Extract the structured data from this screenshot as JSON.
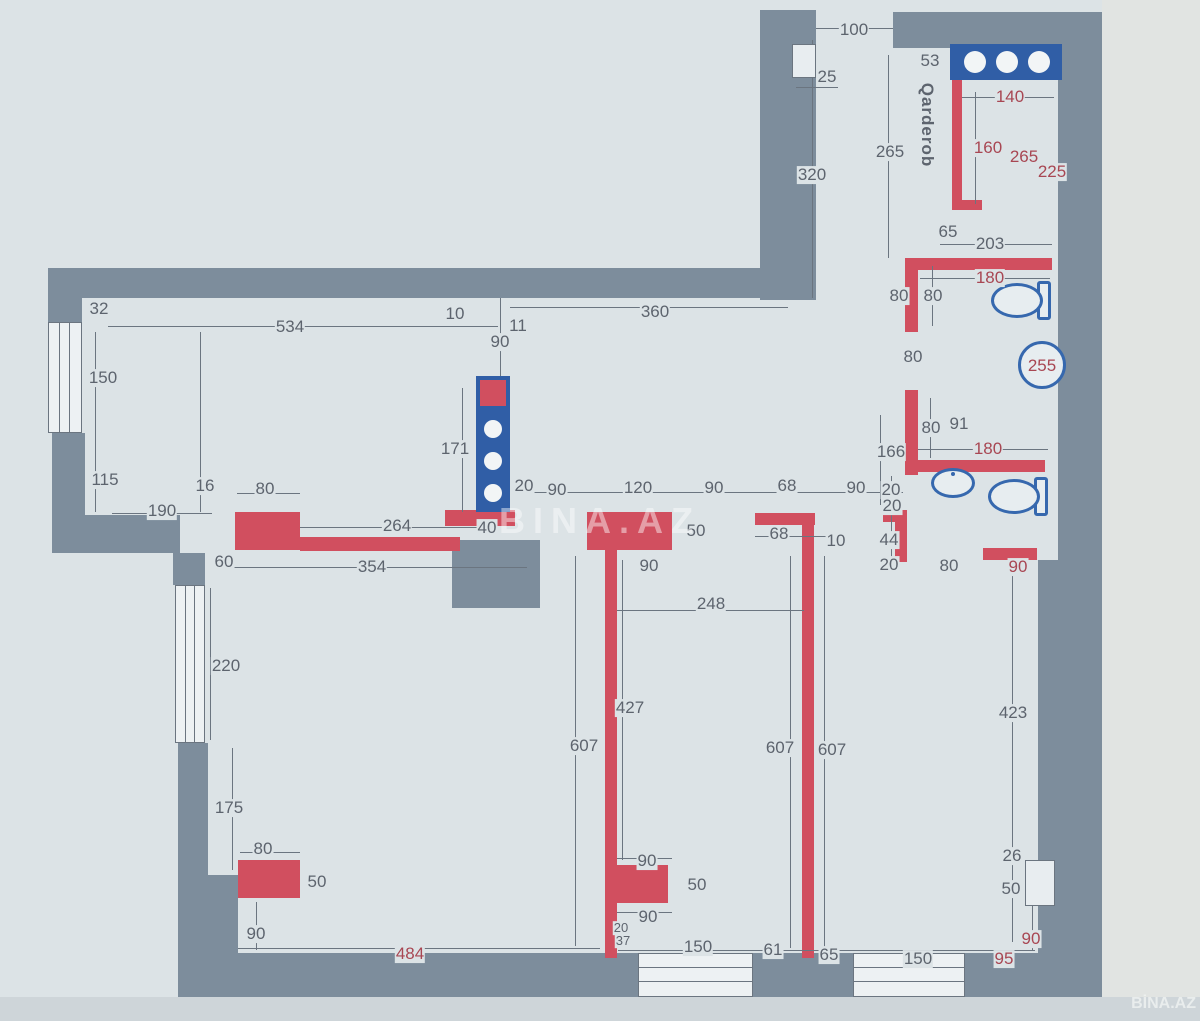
{
  "plan": {
    "colors": {
      "paper": "#dce3e6",
      "wall_gray": "#7d8d9c",
      "wall_red": "#d14f5f",
      "fixture_blue": "#3668ae",
      "shelf_blue": "#305ea6",
      "label_dark": "#5d646e",
      "label_red": "#a84753"
    },
    "room_label": {
      "text": "Qarderob"
    },
    "labels": [
      {
        "t": "100",
        "x": 854,
        "y": 30
      },
      {
        "t": "25",
        "x": 827,
        "y": 77
      },
      {
        "t": "320",
        "x": 812,
        "y": 175
      },
      {
        "t": "53",
        "x": 930,
        "y": 61
      },
      {
        "t": "Qarderob",
        "x": 927,
        "y": 125,
        "v": 1,
        "n": "room-label-qarderob"
      },
      {
        "t": "265",
        "x": 890,
        "y": 152
      },
      {
        "t": "140",
        "x": 1010,
        "y": 97,
        "c": "r"
      },
      {
        "t": "160",
        "x": 988,
        "y": 148,
        "c": "r"
      },
      {
        "t": "265",
        "x": 1024,
        "y": 157,
        "c": "r"
      },
      {
        "t": "225",
        "x": 1052,
        "y": 172,
        "c": "r"
      },
      {
        "t": "65",
        "x": 948,
        "y": 232
      },
      {
        "t": "203",
        "x": 990,
        "y": 244
      },
      {
        "t": "180",
        "x": 990,
        "y": 278,
        "c": "r"
      },
      {
        "t": "80",
        "x": 899,
        "y": 296
      },
      {
        "t": "80",
        "x": 933,
        "y": 296
      },
      {
        "t": "80",
        "x": 913,
        "y": 357
      },
      {
        "t": "255",
        "x": 1042,
        "y": 366,
        "c": "r",
        "nb": 1
      },
      {
        "t": "80",
        "x": 931,
        "y": 428
      },
      {
        "t": "91",
        "x": 959,
        "y": 424
      },
      {
        "t": "166",
        "x": 891,
        "y": 452
      },
      {
        "t": "180",
        "x": 988,
        "y": 449,
        "c": "r"
      },
      {
        "t": "20",
        "x": 892,
        "y": 506
      },
      {
        "t": "44",
        "x": 889,
        "y": 540
      },
      {
        "t": "20",
        "x": 889,
        "y": 565
      },
      {
        "t": "80",
        "x": 949,
        "y": 566
      },
      {
        "t": "90",
        "x": 1018,
        "y": 567,
        "c": "r"
      },
      {
        "t": "32",
        "x": 99,
        "y": 309
      },
      {
        "t": "534",
        "x": 290,
        "y": 327
      },
      {
        "t": "10",
        "x": 455,
        "y": 314
      },
      {
        "t": "11",
        "x": 518,
        "y": 326
      },
      {
        "t": "90",
        "x": 500,
        "y": 342
      },
      {
        "t": "360",
        "x": 655,
        "y": 312
      },
      {
        "t": "150",
        "x": 103,
        "y": 378
      },
      {
        "t": "115",
        "x": 105,
        "y": 480
      },
      {
        "t": "190",
        "x": 162,
        "y": 511
      },
      {
        "t": "16",
        "x": 205,
        "y": 486
      },
      {
        "t": "80",
        "x": 265,
        "y": 489
      },
      {
        "t": "171",
        "x": 455,
        "y": 449
      },
      {
        "t": "20",
        "x": 524,
        "y": 486
      },
      {
        "t": "264",
        "x": 397,
        "y": 526
      },
      {
        "t": "40",
        "x": 487,
        "y": 528
      },
      {
        "t": "354",
        "x": 372,
        "y": 567
      },
      {
        "t": "60",
        "x": 224,
        "y": 562
      },
      {
        "t": "90",
        "x": 557,
        "y": 490
      },
      {
        "t": "120",
        "x": 638,
        "y": 488
      },
      {
        "t": "90",
        "x": 714,
        "y": 488
      },
      {
        "t": "68",
        "x": 787,
        "y": 486
      },
      {
        "t": "90",
        "x": 856,
        "y": 488
      },
      {
        "t": "20",
        "x": 891,
        "y": 490
      },
      {
        "t": "50",
        "x": 696,
        "y": 531
      },
      {
        "t": "68",
        "x": 779,
        "y": 534
      },
      {
        "t": "10",
        "x": 836,
        "y": 541
      },
      {
        "t": "90",
        "x": 649,
        "y": 566
      },
      {
        "t": "248",
        "x": 711,
        "y": 604
      },
      {
        "t": "220",
        "x": 226,
        "y": 666
      },
      {
        "t": "175",
        "x": 229,
        "y": 808
      },
      {
        "t": "80",
        "x": 263,
        "y": 849
      },
      {
        "t": "50",
        "x": 317,
        "y": 882
      },
      {
        "t": "90",
        "x": 256,
        "y": 934
      },
      {
        "t": "484",
        "x": 410,
        "y": 954,
        "c": "r"
      },
      {
        "t": "427",
        "x": 630,
        "y": 708
      },
      {
        "t": "607",
        "x": 584,
        "y": 746
      },
      {
        "t": "607",
        "x": 780,
        "y": 748
      },
      {
        "t": "607",
        "x": 832,
        "y": 750
      },
      {
        "t": "90",
        "x": 647,
        "y": 861
      },
      {
        "t": "50",
        "x": 697,
        "y": 885
      },
      {
        "t": "90",
        "x": 648,
        "y": 917
      },
      {
        "t": "20",
        "x": 621,
        "y": 928,
        "s": 13
      },
      {
        "t": "37",
        "x": 623,
        "y": 941,
        "s": 13
      },
      {
        "t": "150",
        "x": 698,
        "y": 947
      },
      {
        "t": "61",
        "x": 773,
        "y": 950
      },
      {
        "t": "65",
        "x": 829,
        "y": 955
      },
      {
        "t": "423",
        "x": 1013,
        "y": 713
      },
      {
        "t": "26",
        "x": 1012,
        "y": 856
      },
      {
        "t": "50",
        "x": 1011,
        "y": 889
      },
      {
        "t": "90",
        "x": 1031,
        "y": 939,
        "c": "r"
      },
      {
        "t": "95",
        "x": 1004,
        "y": 959,
        "c": "r"
      },
      {
        "t": "150",
        "x": 918,
        "y": 959
      }
    ],
    "watermarks": {
      "center": "BINA.AZ",
      "corner": "BİNA.AZ"
    }
  }
}
